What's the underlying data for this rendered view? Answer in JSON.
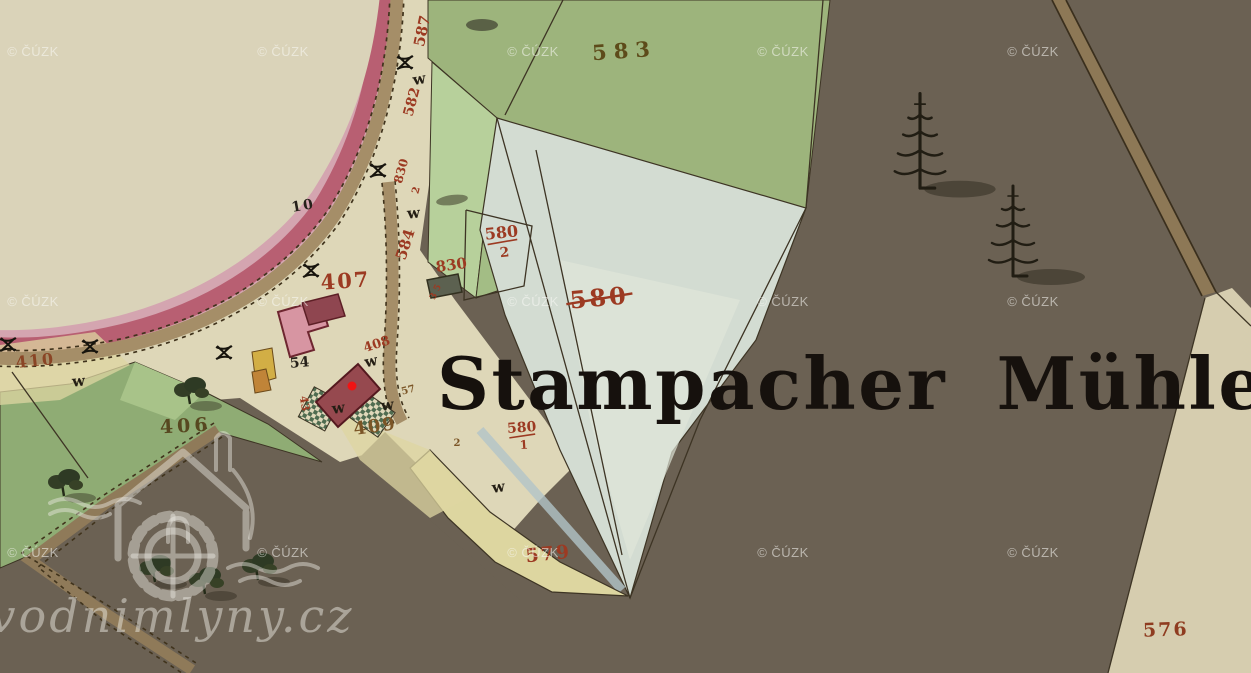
{
  "map": {
    "title": "Stampacher Mühle",
    "site_watermark": "vodnimlyny.cz",
    "watermark": {
      "text": "© ČÚZK",
      "cols": [
        33,
        283,
        533,
        783,
        1033
      ],
      "rows": [
        56,
        306,
        557
      ]
    },
    "palette": {
      "red": "#9c3a22",
      "red2": "#8f3c20",
      "brown": "#7b5526",
      "olive": "#5d4b1a",
      "olive2": "#574820",
      "black": "#26211a",
      "rbrown": "#8a4525"
    },
    "meadow_symbol": "w",
    "parcel_labels": [
      {
        "t": "587",
        "x": 427,
        "y": 32,
        "s": 15,
        "c": "red",
        "r": -78
      },
      {
        "t": "583",
        "x": 625,
        "y": 58,
        "s": 21,
        "c": "olive",
        "r": -4,
        "ls": 7
      },
      {
        "t": "582",
        "x": 416,
        "y": 103,
        "s": 14,
        "c": "red",
        "r": -75
      },
      {
        "t": "830",
        "x": 405,
        "y": 172,
        "s": 12,
        "c": "red",
        "r": -75
      },
      {
        "t": "2",
        "x": 419,
        "y": 191,
        "s": 10,
        "c": "red",
        "r": -75
      },
      {
        "t": "584",
        "x": 410,
        "y": 246,
        "s": 15,
        "c": "red",
        "r": -72
      },
      {
        "t": "830",
        "x": 452,
        "y": 270,
        "s": 15,
        "c": "red",
        "r": -8
      },
      {
        "t": "3 5",
        "x": 438,
        "y": 293,
        "s": 9,
        "c": "red",
        "r": -65
      },
      {
        "t": "580",
        "x": 502,
        "y": 238,
        "s": 16,
        "c": "red",
        "r": -6,
        "fr": {
          "den": "2",
          "w": 30
        }
      },
      {
        "t": "580",
        "x": 600,
        "y": 306,
        "s": 24,
        "c": "red",
        "r": -5,
        "strike": true,
        "ls": 3
      },
      {
        "t": "10",
        "x": 304,
        "y": 210,
        "s": 14,
        "c": "black",
        "r": -10,
        "ls": 2
      },
      {
        "t": "407",
        "x": 346,
        "y": 288,
        "s": 21,
        "c": "red",
        "r": -4,
        "ls": 2
      },
      {
        "t": "408",
        "x": 378,
        "y": 348,
        "s": 13,
        "c": "red",
        "r": -18
      },
      {
        "t": "54",
        "x": 300,
        "y": 367,
        "s": 14,
        "c": "black",
        "r": -5
      },
      {
        "t": "57",
        "x": 409,
        "y": 393,
        "s": 10,
        "c": "brown",
        "r": -15
      },
      {
        "t": "43",
        "x": 301,
        "y": 404,
        "s": 11,
        "c": "red",
        "r": 80
      },
      {
        "t": "410",
        "x": 36,
        "y": 366,
        "s": 16,
        "c": "rbrown",
        "r": -6,
        "ls": 2
      },
      {
        "t": "406",
        "x": 186,
        "y": 432,
        "s": 19,
        "c": "olive2",
        "r": -3,
        "ls": 4
      },
      {
        "t": "409",
        "x": 376,
        "y": 432,
        "s": 18,
        "c": "brown",
        "r": -8,
        "ls": 2
      },
      {
        "t": "2",
        "x": 457,
        "y": 446,
        "s": 10,
        "c": "brown",
        "r": 0
      },
      {
        "t": "580",
        "x": 522,
        "y": 432,
        "s": 14,
        "c": "red",
        "r": -4,
        "fr": {
          "den": "1",
          "w": 26
        }
      },
      {
        "t": "579",
        "x": 549,
        "y": 560,
        "s": 19,
        "c": "red",
        "r": -6,
        "ls": 2
      },
      {
        "t": "576",
        "x": 1166,
        "y": 636,
        "s": 19,
        "c": "red2",
        "r": -2,
        "ls": 2
      }
    ],
    "meadow_marks": [
      {
        "x": 420,
        "y": 84,
        "r": -10
      },
      {
        "x": 414,
        "y": 218,
        "r": -5
      },
      {
        "x": 79,
        "y": 386,
        "r": -5
      },
      {
        "x": 372,
        "y": 366,
        "r": -12
      },
      {
        "x": 339,
        "y": 413,
        "r": -8
      },
      {
        "x": 388,
        "y": 410,
        "r": -8
      },
      {
        "x": 499,
        "y": 492,
        "r": -8
      }
    ],
    "conifers": [
      {
        "x": 920,
        "y": 186,
        "sc": 1.05
      },
      {
        "x": 1013,
        "y": 274,
        "sc": 1.0
      }
    ],
    "trees": [
      {
        "x": 190,
        "y": 402
      },
      {
        "x": 64,
        "y": 494
      },
      {
        "x": 155,
        "y": 580
      },
      {
        "x": 205,
        "y": 592
      },
      {
        "x": 258,
        "y": 578
      }
    ],
    "bushes": [
      {
        "x": 405,
        "y": 63
      },
      {
        "x": 378,
        "y": 171
      },
      {
        "x": 311,
        "y": 271
      },
      {
        "x": 224,
        "y": 353
      },
      {
        "x": 90,
        "y": 347
      },
      {
        "x": 8,
        "y": 345
      }
    ]
  }
}
